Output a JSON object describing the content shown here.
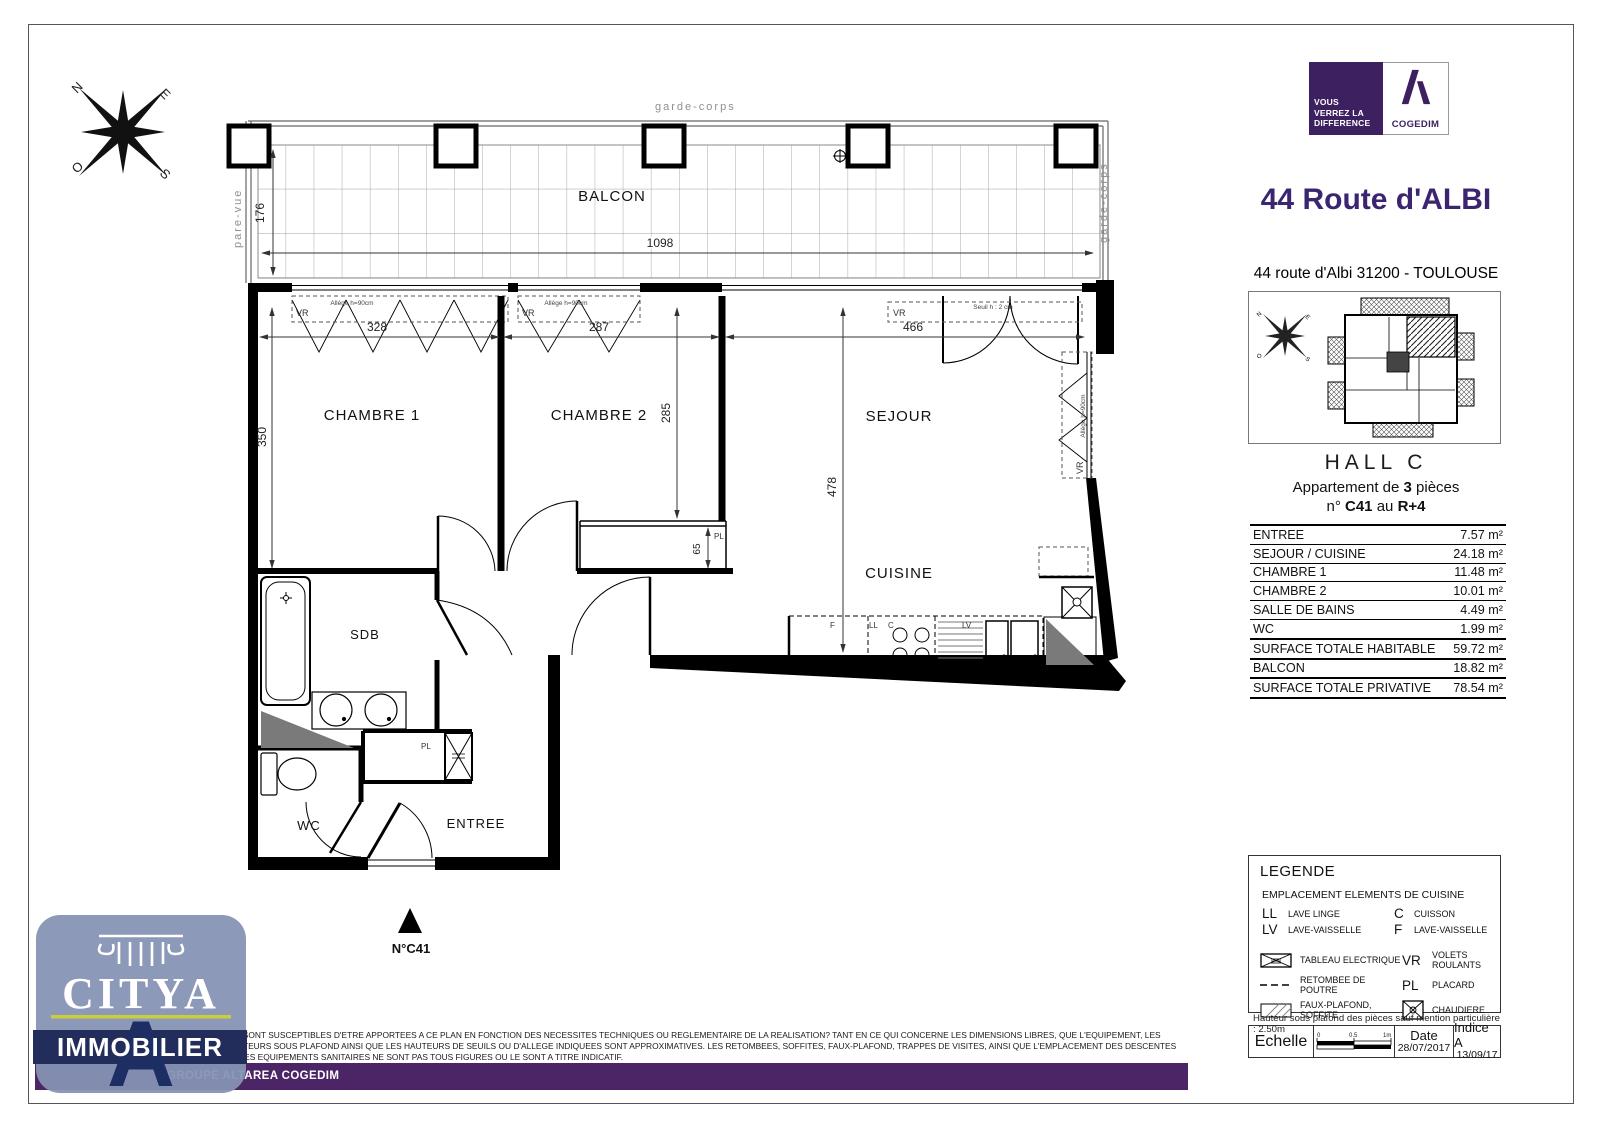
{
  "header": {
    "title": "44 Route d'ALBI",
    "address": "44 route d'Albi 31200 - TOULOUSE"
  },
  "cogedim": {
    "tagline1": "VOUS",
    "tagline2": "VERREZ LA",
    "tagline3": "DIFFERENCE",
    "name": "COGEDIM"
  },
  "citya": {
    "name": "CITYA",
    "sub": "IMMOBILIER"
  },
  "unit": {
    "hall": "HALL C",
    "apt_pre": "Appartement de ",
    "apt_num": "3",
    "apt_post": " pièces",
    "no_pre": "n° ",
    "no_num": "C41",
    "no_mid": " au ",
    "no_floor": "R+4"
  },
  "surface_table": {
    "rows": [
      {
        "label": "ENTREE",
        "value": "7.57 m²"
      },
      {
        "label": "SEJOUR / CUISINE",
        "value": "24.18 m²"
      },
      {
        "label": "CHAMBRE 1",
        "value": "11.48 m²"
      },
      {
        "label": "CHAMBRE 2",
        "value": "10.01 m²"
      },
      {
        "label": "SALLE DE BAINS",
        "value": "4.49 m²"
      },
      {
        "label": "WC",
        "value": "1.99 m²"
      },
      {
        "label": "SURFACE TOTALE HABITABLE",
        "value": "59.72 m²"
      },
      {
        "label": "BALCON",
        "value": "18.82 m²"
      },
      {
        "label": "SURFACE TOTALE PRIVATIVE",
        "value": "78.54 m²"
      }
    ]
  },
  "legend": {
    "title": "LEGENDE",
    "subtitle": "EMPLACEMENT ELEMENTS DE CUISINE",
    "ll_abbr": "LL",
    "ll": "LAVE LINGE",
    "lv_abbr": "LV",
    "lv": "LAVE-VAISSELLE",
    "c_abbr": "C",
    "c": "CUISSON",
    "f_abbr": "F",
    "f": "LAVE-VAISSELLE",
    "tableau": "TABLEAU ELECTRIQUE",
    "retombee": "RETOMBEE DE POUTRE",
    "faux_plafond": "FAUX-PLAFOND, SOFFITE",
    "vr_abbr": "VR",
    "vr": "VOLETS ROULANTS",
    "pl_abbr": "PL",
    "pl": "PLACARD",
    "chaudiere": "CHAUDIERE"
  },
  "scale_block": {
    "echelle": "Echelle",
    "t0": "0",
    "t05": "0.5",
    "t1": "1m",
    "date_label": "Date",
    "date": "28/07/2017",
    "indice_label": "Indice A",
    "indice_date": "13/09/17"
  },
  "notes": {
    "ceiling": "Hauteur sous plafond des pièces sauf mention particulière : 2.50m",
    "disclaimer": "DES MODIFICATIONS SONT SUSCEPTIBLES D'ETRE APPORTEES A CE PLAN EN FONCTION DES NECESSITES TECHNIQUES OU REGLEMENTAIRE DE LA REALISATION? TANT EN CE QUI CONCERNE LES DIMENSIONS LIBRES, QUE L'EQUIPEMENT, LES SURFACES? LES HAUTEURS SOUS PLAFOND AINSI QUE LES HAUTEURS DE SEUILS OU D'ALLEGE INDIQUEES SONT APPROXIMATIVES. LES RETOMBEES, SOFFITES, FAUX-PLAFOND, TRAPPES DE VISITES, AINSI QUE L'EMPLACEMENT DES DESCENTES D'EAUX PLUVIALES, DES EQUIPEMENTS SANITAIRES NE SONT PAS TOUS FIGURES OU LE SONT A TITRE INDICATIF.",
    "footer_bar": "GROUPE ALTAREA COGEDIM"
  },
  "plan": {
    "balcon": "BALCON",
    "garde_corps": "garde-corps",
    "pare_vue": "pare-vue",
    "chambre1": "CHAMBRE 1",
    "chambre2": "CHAMBRE 2",
    "sejour": "SEJOUR",
    "cuisine": "CUISINE",
    "sdb": "SDB",
    "wc": "WC",
    "entree": "ENTREE",
    "marker": "N°C41",
    "dims": {
      "d328": "328",
      "d287": "287",
      "d466": "466",
      "d350": "350",
      "d285": "285",
      "d478": "478",
      "d65": "65",
      "d176": "176",
      "d1098": "1098"
    },
    "tags": {
      "vr": "VR",
      "pl": "PL",
      "allege": "Allège h=90cm",
      "seuil": "Seuil h : 2 cm",
      "f": "F",
      "ll": "LL",
      "c": "C",
      "lv": "LV"
    },
    "compass": {
      "n": "N",
      "e": "E",
      "s": "S",
      "o": "O"
    }
  }
}
